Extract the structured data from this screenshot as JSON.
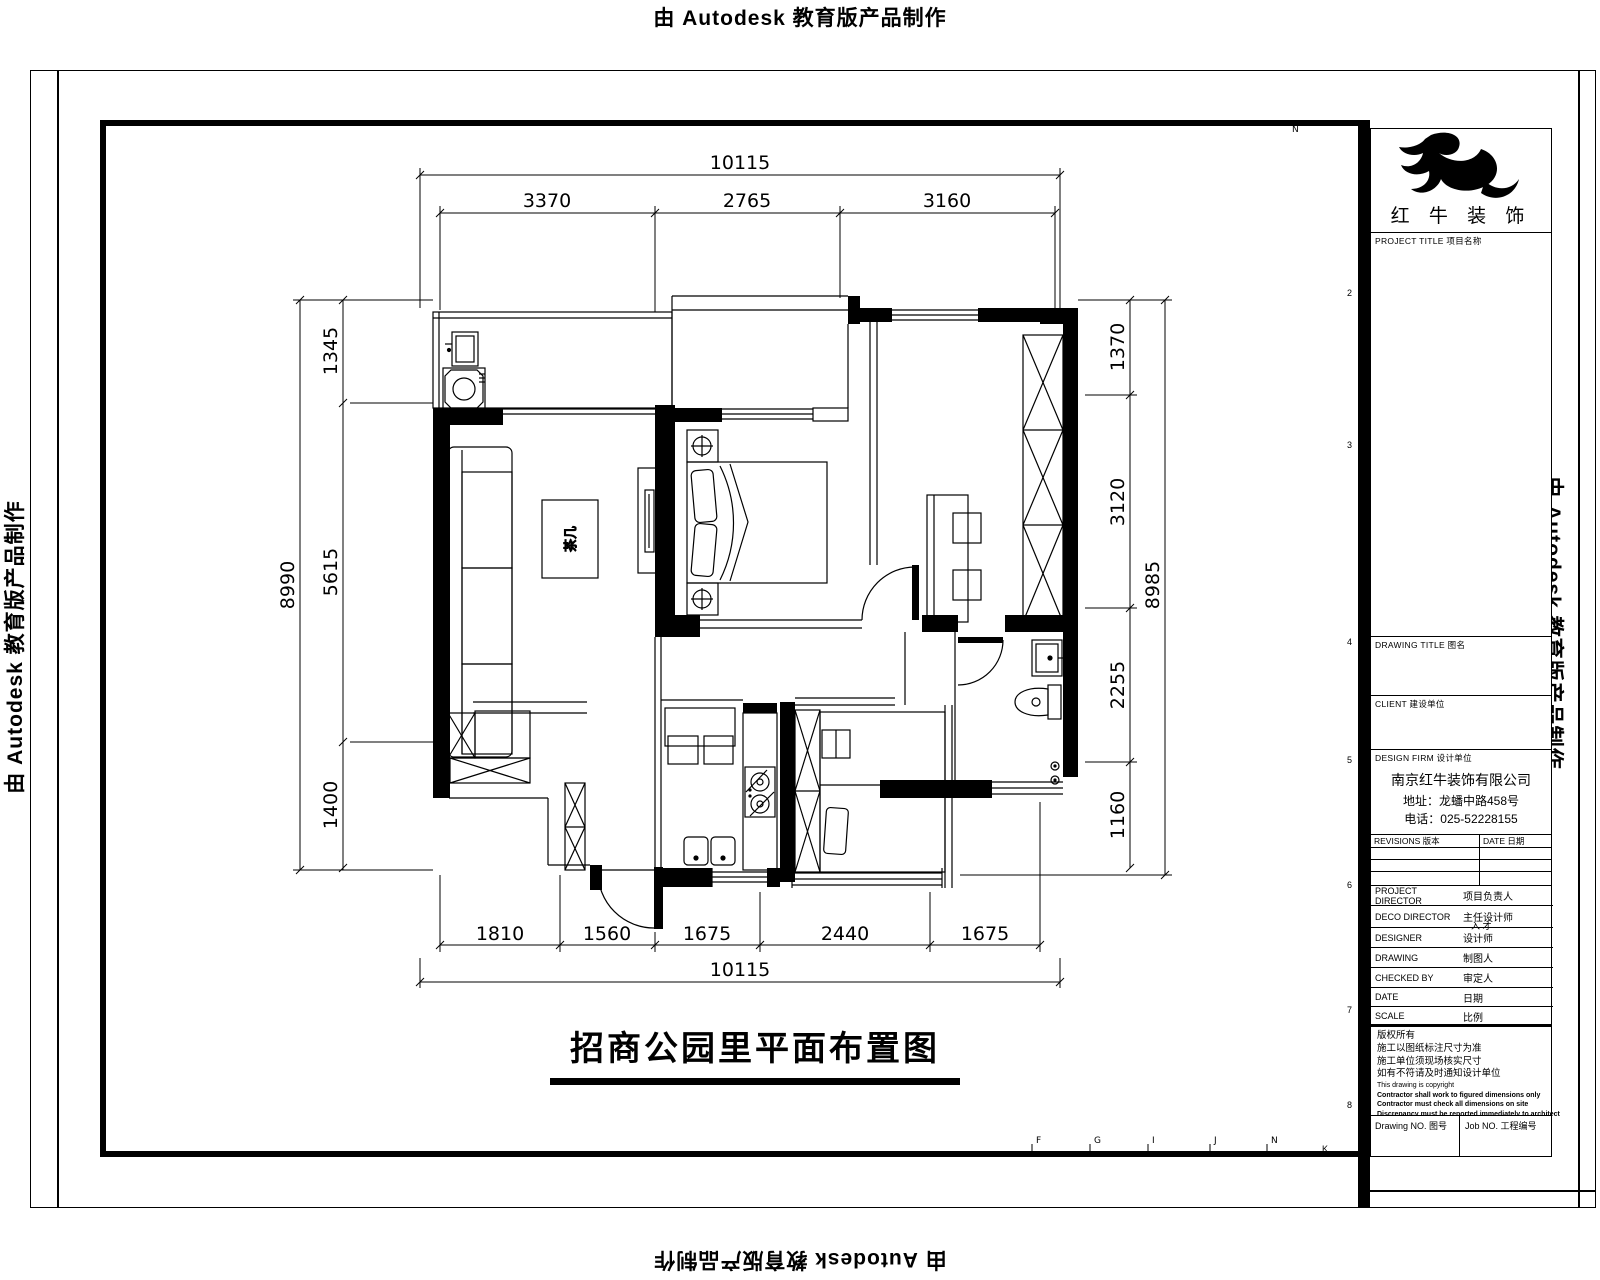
{
  "banner": "由 Autodesk 教育版产品制作",
  "sheet": {
    "zone_numbers": [
      "2",
      "3",
      "4",
      "5",
      "6",
      "7",
      "8",
      "9"
    ],
    "zone_letter_k": "K",
    "grid_letters": [
      "F",
      "G",
      "I",
      "J",
      "N"
    ],
    "north_mark": "N"
  },
  "plan": {
    "title": "招商公园里平面布置图",
    "labels": {
      "coffee_table": "茶几"
    },
    "dims": {
      "top_total": "10115",
      "top_1": "3370",
      "top_2": "2765",
      "top_3": "3160",
      "left_total": "8990",
      "left_1": "1345",
      "left_2": "5615",
      "left_3": "1400",
      "right_total": "8985",
      "right_1": "1370",
      "right_2": "3120",
      "right_3": "2255",
      "right_4": "1160",
      "bottom_1": "1810",
      "bottom_2": "1560",
      "bottom_3": "1675",
      "bottom_4": "2440",
      "bottom_5": "1675",
      "bottom_total": "10115"
    }
  },
  "titleblock": {
    "brand": "红 牛 装 饰",
    "project_label": "PROJECT TITLE 项目名称",
    "drawing_title_label": "DRAWING TITLE 图名",
    "client_label": "CLIENT 建设单位",
    "firm_label": "DESIGN FIRM 设计单位",
    "firm_name": "南京红牛装饰有限公司",
    "firm_address": "地址：龙蟠中路458号",
    "firm_phone": "电话：025-52228155",
    "revisions_label": "REVISIONS 版本",
    "date_col_label": "DATE 日期",
    "rows": [
      {
        "en": "PROJECT DIRECTOR",
        "cn": "项目负责人",
        "value": ""
      },
      {
        "en": "DECO DIRECTOR",
        "cn": "主任设计师",
        "value": "入 才"
      },
      {
        "en": "DESIGNER",
        "cn": "设计师",
        "value": ""
      },
      {
        "en": "DRAWING",
        "cn": "制图人",
        "value": ""
      },
      {
        "en": "CHECKED BY",
        "cn": "审定人",
        "value": ""
      },
      {
        "en": "DATE",
        "cn": "日期",
        "value": ""
      },
      {
        "en": "SCALE",
        "cn": "比例",
        "value": ""
      }
    ],
    "notes": [
      "版权所有",
      "施工以图纸标注尺寸为准",
      "施工单位须现场核实尺寸",
      "如有不符请及时通知设计单位",
      "This drawing is copyright",
      "Contractor shall work to figured dimensions only",
      "Contractor must check all dimensions on site",
      "Discrepancy must be reported immediately to architect"
    ],
    "drawing_no_label": "Drawing NO. 图号",
    "job_no_label": "Job NO. 工程编号"
  }
}
